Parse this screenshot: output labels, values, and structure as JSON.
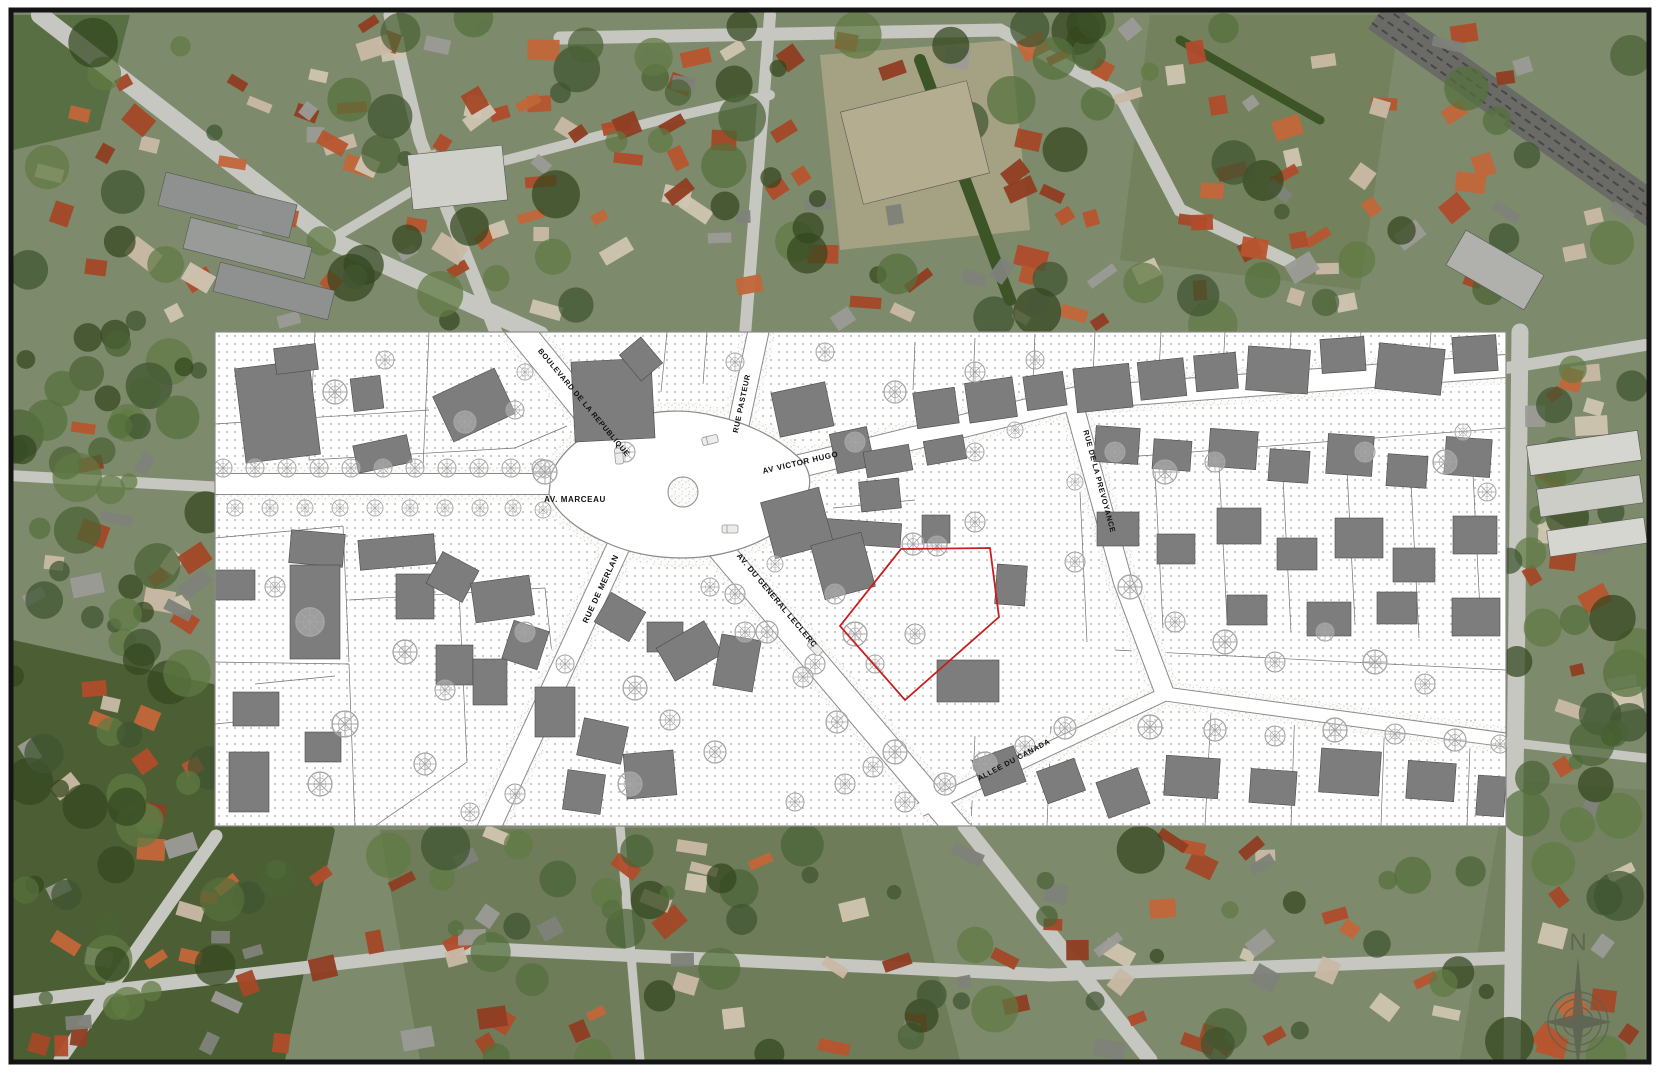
{
  "page": {
    "background": "#ffffff",
    "frame_color": "#141414"
  },
  "photo": {
    "base": "#7e8a6c",
    "roof_palette": [
      "#b7552f",
      "#c2663a",
      "#a34827",
      "#8f3d22",
      "#c9b9a5",
      "#9b9b97",
      "#7e8279",
      "#d0c5b2",
      "#b04c2b"
    ],
    "tree_palette": [
      "#3f5530",
      "#4a6234",
      "#55703c",
      "#33471f",
      "#5f7a43"
    ],
    "road_color": "#c6c7c1",
    "railway_color": "#6a6a66",
    "patches": [
      {
        "d": "M 13,640 L 240,690 L 335,830 L 285,1060 L 13,1060 Z",
        "fill": "#46592f",
        "op": 0.9
      },
      {
        "d": "M 13,15 L 130,15 L 100,130 L 13,150 Z",
        "fill": "#4f6639",
        "op": 0.8
      },
      {
        "d": "M 820,55 L 1010,40 L 1030,230 L 840,250 Z",
        "fill": "#b3a98c",
        "op": 0.75
      },
      {
        "d": "M 1150,15 L 1400,15 L 1360,290 L 1120,260 Z",
        "fill": "#6d7c52",
        "op": 0.6
      },
      {
        "d": "M 380,830 L 900,826 L 960,1060 L 420,1060 Z",
        "fill": "#5d6e48",
        "op": 0.5
      },
      {
        "d": "M 1506,780 L 1645,790 L 1645,1060 L 1460,1060 Z",
        "fill": "#707d5c",
        "op": 0.6
      }
    ],
    "roads": [
      {
        "d": "M 40,15 L 330,240 L 540,335",
        "w": 18
      },
      {
        "d": "M 330,240 L 430,180 L 660,120 L 770,95",
        "w": 10
      },
      {
        "d": "M 497,335 L 420,140 L 390,15",
        "w": 13
      },
      {
        "d": "M 745,335 L 762,120 L 770,15",
        "w": 12
      },
      {
        "d": "M 560,38 L 1000,30 L 1120,95 L 1180,210 L 1290,262",
        "w": 13
      },
      {
        "d": "M 0,475 L 216,487",
        "w": 11
      },
      {
        "d": "M 1506,368 L 1645,345",
        "w": 12
      },
      {
        "d": "M 1520,332 L 1512,1060",
        "w": 17
      },
      {
        "d": "M 216,836 L 60,1060",
        "w": 13
      },
      {
        "d": "M 965,826 L 1150,1060",
        "w": 15
      },
      {
        "d": "M 1506,742 L 1645,758",
        "w": 9
      },
      {
        "d": "M 13,1002 L 470,948 L 1050,975 L 1506,958",
        "w": 13
      },
      {
        "d": "M 620,826 L 640,1060",
        "w": 9
      }
    ],
    "hedges": [
      {
        "d": "M 920,60 L 1010,300",
        "w": 12
      },
      {
        "d": "M 1180,40 L 1320,120",
        "w": 9
      }
    ],
    "railway": {
      "d": "M 1378,15 L 1660,215",
      "w": 34
    },
    "blocks": [
      {
        "x": 160,
        "y": 188,
        "w": 135,
        "h": 34,
        "rot": 14,
        "fill": "#8e9190"
      },
      {
        "x": 185,
        "y": 232,
        "w": 125,
        "h": 32,
        "rot": 14,
        "fill": "#989b98"
      },
      {
        "x": 215,
        "y": 276,
        "w": 118,
        "h": 30,
        "rot": 14,
        "fill": "#8e9190"
      },
      {
        "x": 410,
        "y": 150,
        "w": 95,
        "h": 55,
        "rot": -6,
        "fill": "#cfd0ca"
      },
      {
        "x": 850,
        "y": 95,
        "w": 130,
        "h": 95,
        "rot": -14,
        "fill": "#b5ad90"
      },
      {
        "x": 1528,
        "y": 438,
        "w": 112,
        "h": 30,
        "rot": -8,
        "fill": "#d6d6d0"
      },
      {
        "x": 1538,
        "y": 482,
        "w": 104,
        "h": 28,
        "rot": -8,
        "fill": "#cccdc6"
      },
      {
        "x": 1548,
        "y": 524,
        "w": 98,
        "h": 26,
        "rot": -8,
        "fill": "#d6d6d0"
      },
      {
        "x": 1450,
        "y": 250,
        "w": 90,
        "h": 40,
        "rot": 30,
        "fill": "#b0b1ac"
      }
    ],
    "zones": [
      {
        "x": 13,
        "y": 15,
        "w": 1632,
        "h": 315,
        "houses": 155,
        "trees": 85,
        "seed": 101
      },
      {
        "x": 13,
        "y": 828,
        "w": 1632,
        "h": 230,
        "houses": 95,
        "trees": 70,
        "seed": 202
      },
      {
        "x": 13,
        "y": 334,
        "w": 200,
        "h": 492,
        "houses": 26,
        "trees": 55,
        "seed": 303
      },
      {
        "x": 1508,
        "y": 334,
        "w": 137,
        "h": 492,
        "houses": 20,
        "trees": 28,
        "seed": 404
      }
    ]
  },
  "plan": {
    "x": 215,
    "y": 332,
    "width": 1291,
    "height": 494,
    "colors": {
      "paper": "#ffffff",
      "dot": "#9a9a9a",
      "street_edge": "#8a8a8a",
      "building": "#7d7d7d",
      "building_edge": "#4a4a4a",
      "tree": "#a5a5a5",
      "parcel_line": "#6f6f6f",
      "red": "#c81e1e",
      "label": "#111111",
      "border": "#8a8a8a"
    },
    "street_labels": [
      {
        "id": "boulevard-de-la-republique",
        "text": "BOULEVARD DE LA REPUBLIQUE",
        "x": 367,
        "y": 72,
        "rotate": 50,
        "size": 7.5
      },
      {
        "id": "av-marceau",
        "text": "AV. MARCEAU",
        "x": 360,
        "y": 170,
        "rotate": 0,
        "size": 8
      },
      {
        "id": "rue-pasteur",
        "text": "RUE PASTEUR",
        "x": 529,
        "y": 72,
        "rotate": -78,
        "size": 7.5
      },
      {
        "id": "av-victor-hugo",
        "text": "AV VICTOR HUGO",
        "x": 586,
        "y": 133,
        "rotate": -13,
        "size": 8
      },
      {
        "id": "rue-de-la-prevoyance",
        "text": "RUE DE LA PREVOYANCE",
        "x": 882,
        "y": 150,
        "rotate": 75,
        "size": 7.5
      },
      {
        "id": "rue-de-merlan",
        "text": "RUE DE MERLAN",
        "x": 388,
        "y": 258,
        "rotate": -65,
        "size": 8
      },
      {
        "id": "av-du-general-leclerc",
        "text": "AV. DU GENERAL LECLERC",
        "x": 560,
        "y": 270,
        "rotate": 50,
        "size": 8
      },
      {
        "id": "allee-du-canada",
        "text": "ALLEE DU CANADA",
        "x": 800,
        "y": 430,
        "rotate": -28,
        "size": 7.5
      }
    ],
    "streets": [
      {
        "id": "marceau",
        "d": "M 0,152 L 360,152",
        "w": 20
      },
      {
        "id": "republique",
        "d": "M 300,-8 L 420,140",
        "w": 26
      },
      {
        "id": "pasteur",
        "d": "M 545,-8 L 516,128",
        "w": 20
      },
      {
        "id": "victor-hugo",
        "d": "M 520,150 L 862,66 L 1291,34",
        "w": 22
      },
      {
        "id": "prevoyance",
        "d": "M 858,70 L 908,250 L 950,362",
        "w": 18
      },
      {
        "id": "merlan",
        "d": "M 410,200 L 272,500",
        "w": 22
      },
      {
        "id": "leclerc",
        "d": "M 495,205 L 745,500",
        "w": 24
      },
      {
        "id": "canada",
        "d": "M 705,478 L 950,362 L 1291,408",
        "w": 13
      }
    ],
    "plaza": {
      "d": "M 336,142 C 350,112 378,96 408,88 C 438,78 470,76 500,84 C 530,90 560,104 582,124 C 596,136 598,152 590,168 C 576,196 544,214 506,222 C 468,230 424,226 390,210 C 362,198 340,180 334,162 Z",
      "island": {
        "cx": 468,
        "cy": 160,
        "r": 15
      }
    },
    "lot_lines": [
      "M 100,0 L 94,128",
      "M 0,92 L 214,78",
      "M 214,0 L 208,136",
      "M 94,128 L 300,116",
      "M 0,206 L 128,194",
      "M 128,194 L 134,330",
      "M 0,330 L 134,332",
      "M 134,268 L 330,256",
      "M 330,256 L 342,370",
      "M 134,332 L 140,494",
      "M 244,258 L 252,430",
      "M 252,430 L 160,494",
      "M 352,94 L 300,116",
      "M 452,0 L 446,60",
      "M 492,0 L 488,52",
      "M 700,10 L 698,58",
      "M 760,6 L 758,52",
      "M 820,2 L 818,48",
      "M 880,0 L 878,44",
      "M 946,0 L 944,40",
      "M 1010,0 L 1008,36",
      "M 1076,0 L 1074,32",
      "M 1146,0 L 1144,28",
      "M 1216,0 L 1214,26",
      "M 872,128 L 1291,96",
      "M 940,140 L 948,296",
      "M 1004,132 L 1012,288",
      "M 1068,146 L 1076,300",
      "M 1132,138 L 1140,292",
      "M 1196,150 L 1204,306",
      "M 1258,142 L 1266,298",
      "M 865,160 L 872,310",
      "M 900,318 L 1291,338",
      "M 618,176 L 700,168",
      "M 996,380 L 990,494",
      "M 1080,372 L 1076,494",
      "M 1170,380 L 1166,494",
      "M 1256,388 L 1252,494",
      "M 760,404 L 756,494",
      "M 836,394 L 832,494",
      "M 40,352 L 120,344",
      "M 0,392 L 60,386"
    ],
    "buildings": [
      [
        25,
        32,
        75,
        95,
        -7
      ],
      [
        60,
        14,
        42,
        26,
        -7
      ],
      [
        137,
        45,
        30,
        33,
        -7
      ],
      [
        225,
        48,
        68,
        50,
        -25
      ],
      [
        140,
        108,
        55,
        28,
        -12
      ],
      [
        358,
        28,
        80,
        80,
        -3
      ],
      [
        412,
        10,
        28,
        34,
        -40
      ],
      [
        560,
        55,
        55,
        45,
        -12
      ],
      [
        618,
        98,
        38,
        40,
        -12
      ],
      [
        700,
        58,
        42,
        36,
        -8
      ],
      [
        752,
        48,
        48,
        40,
        -8
      ],
      [
        810,
        42,
        40,
        34,
        -8
      ],
      [
        860,
        34,
        56,
        44,
        -6
      ],
      [
        924,
        28,
        46,
        38,
        -6
      ],
      [
        980,
        22,
        42,
        36,
        -5
      ],
      [
        1032,
        16,
        62,
        44,
        4
      ],
      [
        1106,
        6,
        44,
        34,
        -4
      ],
      [
        1162,
        14,
        66,
        46,
        6
      ],
      [
        1238,
        4,
        44,
        36,
        -4
      ],
      [
        578,
        188,
        108,
        24,
        4
      ],
      [
        650,
        116,
        46,
        26,
        -10
      ],
      [
        710,
        106,
        40,
        24,
        -10
      ],
      [
        645,
        148,
        40,
        30,
        -6
      ],
      [
        707,
        183,
        28,
        28,
        0
      ],
      [
        781,
        233,
        30,
        40,
        4
      ],
      [
        880,
        95,
        44,
        36,
        4
      ],
      [
        938,
        108,
        38,
        30,
        4
      ],
      [
        994,
        98,
        48,
        38,
        4
      ],
      [
        1054,
        118,
        40,
        32,
        4
      ],
      [
        1112,
        103,
        46,
        40,
        4
      ],
      [
        1172,
        123,
        40,
        32,
        4
      ],
      [
        1230,
        106,
        46,
        38,
        4
      ],
      [
        882,
        180,
        42,
        34,
        0
      ],
      [
        942,
        202,
        38,
        30,
        0
      ],
      [
        1002,
        176,
        44,
        36,
        0
      ],
      [
        1062,
        206,
        40,
        32,
        0
      ],
      [
        1120,
        186,
        48,
        40,
        0
      ],
      [
        1178,
        216,
        42,
        34,
        0
      ],
      [
        1238,
        184,
        44,
        38,
        0
      ],
      [
        1092,
        270,
        44,
        34,
        0
      ],
      [
        1012,
        263,
        40,
        30,
        0
      ],
      [
        1162,
        260,
        40,
        32,
        0
      ],
      [
        1237,
        266,
        48,
        38,
        0
      ],
      [
        950,
        425,
        54,
        40,
        4
      ],
      [
        1035,
        438,
        46,
        34,
        4
      ],
      [
        1105,
        418,
        60,
        44,
        4
      ],
      [
        1192,
        430,
        48,
        38,
        4
      ],
      [
        1262,
        444,
        28,
        40,
        4
      ],
      [
        722,
        328,
        62,
        42,
        0
      ],
      [
        762,
        420,
        44,
        38,
        -20
      ],
      [
        826,
        432,
        40,
        34,
        -20
      ],
      [
        886,
        442,
        44,
        38,
        -20
      ],
      [
        75,
        200,
        54,
        33,
        5
      ],
      [
        75,
        233,
        50,
        94,
        0
      ],
      [
        144,
        205,
        76,
        30,
        -5
      ],
      [
        181,
        242,
        38,
        45,
        0
      ],
      [
        217,
        227,
        41,
        36,
        28
      ],
      [
        258,
        247,
        59,
        40,
        -8
      ],
      [
        221,
        313,
        37,
        40,
        0
      ],
      [
        258,
        327,
        34,
        46,
        0
      ],
      [
        292,
        293,
        37,
        40,
        18
      ],
      [
        320,
        355,
        40,
        50,
        0
      ],
      [
        365,
        390,
        45,
        38,
        12
      ],
      [
        410,
        420,
        50,
        45,
        -5
      ],
      [
        350,
        440,
        38,
        40,
        8
      ],
      [
        385,
        268,
        40,
        34,
        30
      ],
      [
        432,
        290,
        36,
        30,
        0
      ],
      [
        447,
        300,
        55,
        38,
        -30
      ],
      [
        502,
        305,
        40,
        52,
        10
      ],
      [
        552,
        162,
        60,
        58,
        -15
      ],
      [
        602,
        206,
        52,
        56,
        -15
      ],
      [
        18,
        360,
        46,
        34,
        0
      ],
      [
        14,
        420,
        40,
        60,
        0
      ],
      [
        90,
        400,
        36,
        30,
        0
      ],
      [
        0,
        238,
        40,
        30,
        0
      ]
    ],
    "trees": [
      [
        8,
        136,
        9
      ],
      [
        40,
        136,
        9
      ],
      [
        72,
        136,
        9
      ],
      [
        104,
        136,
        9
      ],
      [
        136,
        136,
        9
      ],
      [
        168,
        136,
        9
      ],
      [
        200,
        136,
        9
      ],
      [
        232,
        136,
        9
      ],
      [
        264,
        136,
        9
      ],
      [
        296,
        136,
        9
      ],
      [
        326,
        136,
        9
      ],
      [
        20,
        176,
        8
      ],
      [
        55,
        176,
        8
      ],
      [
        90,
        176,
        8
      ],
      [
        125,
        176,
        8
      ],
      [
        160,
        176,
        8
      ],
      [
        195,
        176,
        8
      ],
      [
        230,
        176,
        8
      ],
      [
        265,
        176,
        8
      ],
      [
        298,
        176,
        8
      ],
      [
        328,
        178,
        8
      ],
      [
        120,
        60,
        12
      ],
      [
        170,
        28,
        9
      ],
      [
        250,
        90,
        11
      ],
      [
        300,
        78,
        9
      ],
      [
        330,
        140,
        12
      ],
      [
        410,
        120,
        10
      ],
      [
        310,
        40,
        8
      ],
      [
        60,
        255,
        10
      ],
      [
        95,
        290,
        14
      ],
      [
        190,
        320,
        12
      ],
      [
        230,
        358,
        10
      ],
      [
        130,
        392,
        13
      ],
      [
        105,
        452,
        12
      ],
      [
        210,
        432,
        11
      ],
      [
        310,
        300,
        10
      ],
      [
        350,
        332,
        9
      ],
      [
        420,
        356,
        12
      ],
      [
        455,
        388,
        10
      ],
      [
        500,
        420,
        11
      ],
      [
        415,
        452,
        12
      ],
      [
        300,
        462,
        10
      ],
      [
        255,
        480,
        9
      ],
      [
        530,
        300,
        10
      ],
      [
        495,
        255,
        9
      ],
      [
        560,
        232,
        8
      ],
      [
        620,
        262,
        10
      ],
      [
        640,
        302,
        12
      ],
      [
        600,
        332,
        10
      ],
      [
        660,
        332,
        9
      ],
      [
        700,
        302,
        10
      ],
      [
        680,
        420,
        12
      ],
      [
        630,
        452,
        10
      ],
      [
        580,
        470,
        9
      ],
      [
        520,
        30,
        9
      ],
      [
        610,
        20,
        9
      ],
      [
        760,
        40,
        10
      ],
      [
        820,
        28,
        9
      ],
      [
        860,
        150,
        8
      ],
      [
        760,
        120,
        9
      ],
      [
        800,
        98,
        8
      ],
      [
        680,
        60,
        11
      ],
      [
        640,
        110,
        10
      ],
      [
        698,
        212,
        11
      ],
      [
        722,
        214,
        10
      ],
      [
        760,
        190,
        10
      ],
      [
        900,
        120,
        10
      ],
      [
        950,
        140,
        12
      ],
      [
        1000,
        130,
        10
      ],
      [
        860,
        230,
        10
      ],
      [
        915,
        255,
        12
      ],
      [
        960,
        290,
        10
      ],
      [
        1010,
        310,
        12
      ],
      [
        1060,
        330,
        10
      ],
      [
        1110,
        300,
        9
      ],
      [
        1160,
        330,
        12
      ],
      [
        1210,
        352,
        10
      ],
      [
        1150,
        120,
        10
      ],
      [
        1230,
        130,
        12
      ],
      [
        1272,
        160,
        9
      ],
      [
        1248,
        100,
        8
      ],
      [
        935,
        395,
        12
      ],
      [
        1000,
        398,
        11
      ],
      [
        1060,
        404,
        10
      ],
      [
        1120,
        398,
        12
      ],
      [
        1180,
        402,
        10
      ],
      [
        1240,
        408,
        11
      ],
      [
        1285,
        412,
        9
      ],
      [
        520,
        262,
        10
      ],
      [
        552,
        300,
        11
      ],
      [
        588,
        345,
        10
      ],
      [
        622,
        390,
        11
      ],
      [
        658,
        435,
        10
      ],
      [
        690,
        470,
        10
      ],
      [
        730,
        452,
        11
      ],
      [
        770,
        432,
        12
      ],
      [
        810,
        414,
        10
      ],
      [
        850,
        396,
        11
      ]
    ],
    "cars": [
      [
        495,
        108,
        -14
      ],
      [
        515,
        197,
        0
      ],
      [
        600,
        316,
        47
      ],
      [
        404,
        124,
        85
      ]
    ],
    "red_parcel": {
      "points": "686,217 775,216 784,285 690,368 625,294"
    }
  },
  "compass": {
    "letter": "N",
    "cx": 1578,
    "cy": 1022,
    "rings": [
      15,
      23,
      30
    ],
    "color": "#5c6152"
  }
}
